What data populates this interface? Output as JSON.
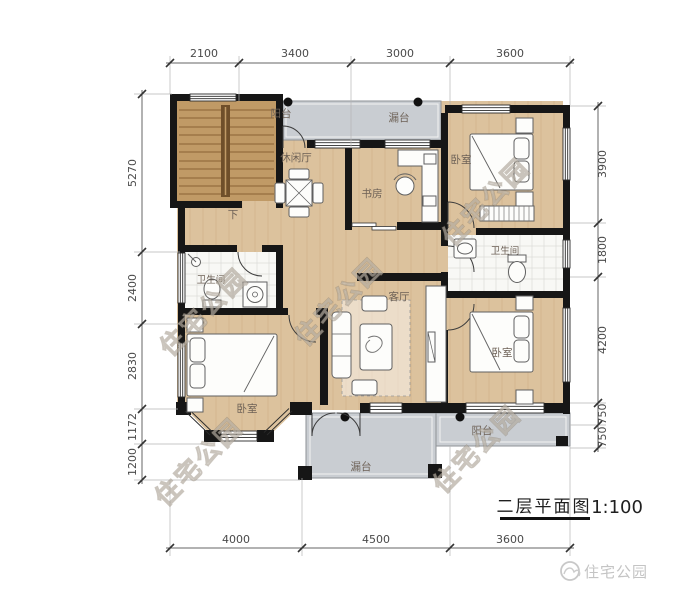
{
  "title": {
    "text": "二层平面图",
    "scale": "1:100"
  },
  "brand": {
    "logo_text": "住宅公园"
  },
  "watermark": {
    "text": "住宅公园"
  },
  "labels": {
    "balcony": "阳台",
    "terrace": "漏台",
    "leisure_hall": "休闲厅",
    "study": "书房",
    "bedroom": "卧室",
    "bathroom": "卫生间",
    "living_room": "客厅",
    "stairs_down": "下"
  },
  "dimensions": {
    "top": [
      "2100",
      "3400",
      "3000",
      "3600"
    ],
    "bottom": [
      "4000",
      "4500",
      "3600"
    ],
    "left": [
      "5270",
      "2400",
      "2830",
      "1172",
      "1200"
    ],
    "right": [
      "3900",
      "1800",
      "4200",
      "750",
      "750"
    ]
  },
  "colors": {
    "wall": "#161616",
    "wood_floor": "#dcc29d",
    "stair_floor": "#c09a66",
    "outdoor_grey": "#c9cdd2",
    "tile": "#f8f8f5",
    "dimension": "#4a4a4a"
  }
}
